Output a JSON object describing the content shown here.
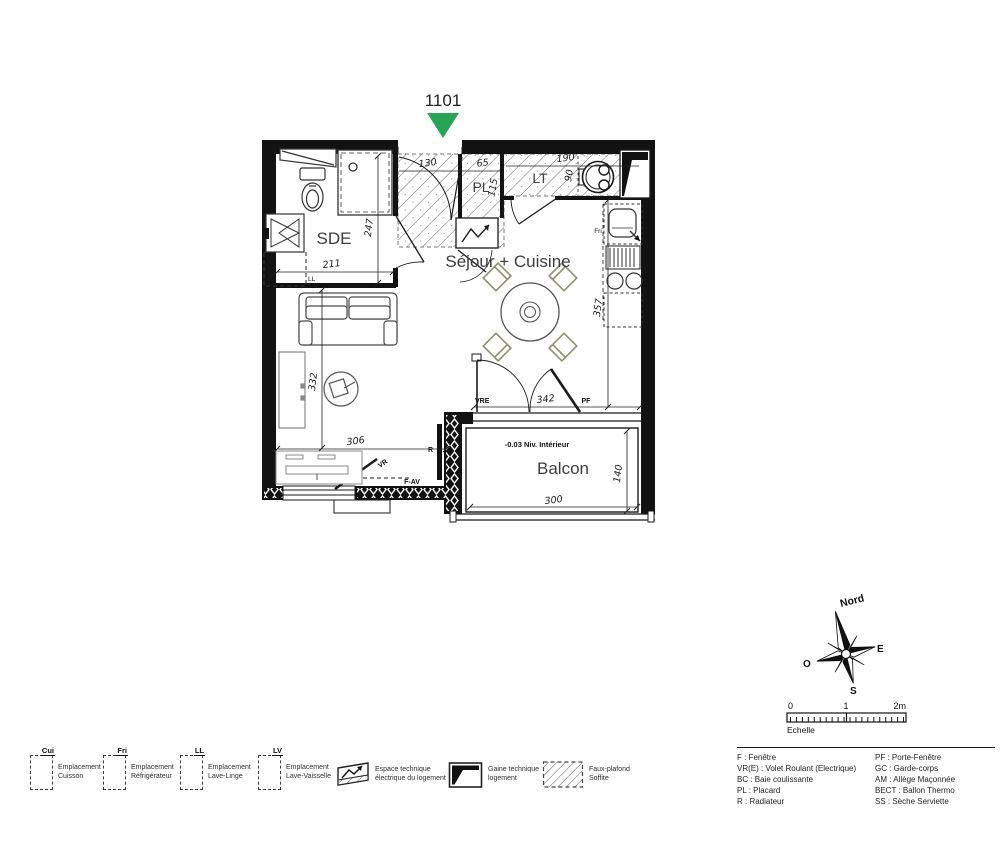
{
  "unit": {
    "number": "1101",
    "marker_color": "#28a457"
  },
  "plan": {
    "rooms": {
      "sde": "SDE",
      "sejour": "Séjour + Cuisine",
      "pl": "PL",
      "lt": "LT",
      "balcon": "Balcon"
    },
    "dims": {
      "entry": "130",
      "pl_w": "65",
      "pl_d": "115",
      "lt_w": "190",
      "lt_d": "90",
      "sde_h": "247",
      "sde_w": "211",
      "kitchen_h": "357",
      "living_h": "332",
      "living_w": "306",
      "bay_w": "342",
      "balcony_w": "300",
      "balcony_d": "140"
    },
    "notes": {
      "level": "-0.03 Niv. Intérieur"
    },
    "tags": {
      "ll": "LL",
      "fri": "Fri",
      "vre": "VRE",
      "pf": "PF",
      "vr": "VR",
      "fav": "F-AV",
      "r": "R"
    }
  },
  "legend": {
    "items": [
      {
        "code": "Cui",
        "line1": "Emplacement",
        "line2": "Cuisson"
      },
      {
        "code": "Fri",
        "line1": "Emplacement",
        "line2": "Réfrigérateur"
      },
      {
        "code": "LL",
        "line1": "Emplacement",
        "line2": "Lave-Linge"
      },
      {
        "code": "LV",
        "line1": "Emplacement",
        "line2": "Lave-Vaisselle"
      },
      {
        "icon": "electrical-space-icon",
        "line1": "Espace technique",
        "line2": "électrique du logement"
      },
      {
        "icon": "technical-duct-icon",
        "line1": "Gaine technique",
        "line2": "logement"
      },
      {
        "icon": "soffit-icon",
        "line1": "Faux-plafond",
        "line2": "Soffite"
      }
    ]
  },
  "abbreviations": {
    "col1": [
      "F : Fenêtre",
      "VR(E) : Volet Roulant (Electrique)",
      "BC : Baie coulissante",
      "PL : Placard",
      "R : Radiateur"
    ],
    "col2": [
      "PF : Porte-Fenêtre",
      "GC : Garde-corps",
      "AM : Allège Maçonnée",
      "BECT : Ballon Thermo",
      "SS : Sèche Serviette"
    ]
  },
  "compass": {
    "north": "Nord",
    "east": "E",
    "south": "S",
    "west": "O"
  },
  "scale": {
    "t0": "0",
    "t1": "1",
    "t2": "2m",
    "label": "Echelle"
  }
}
